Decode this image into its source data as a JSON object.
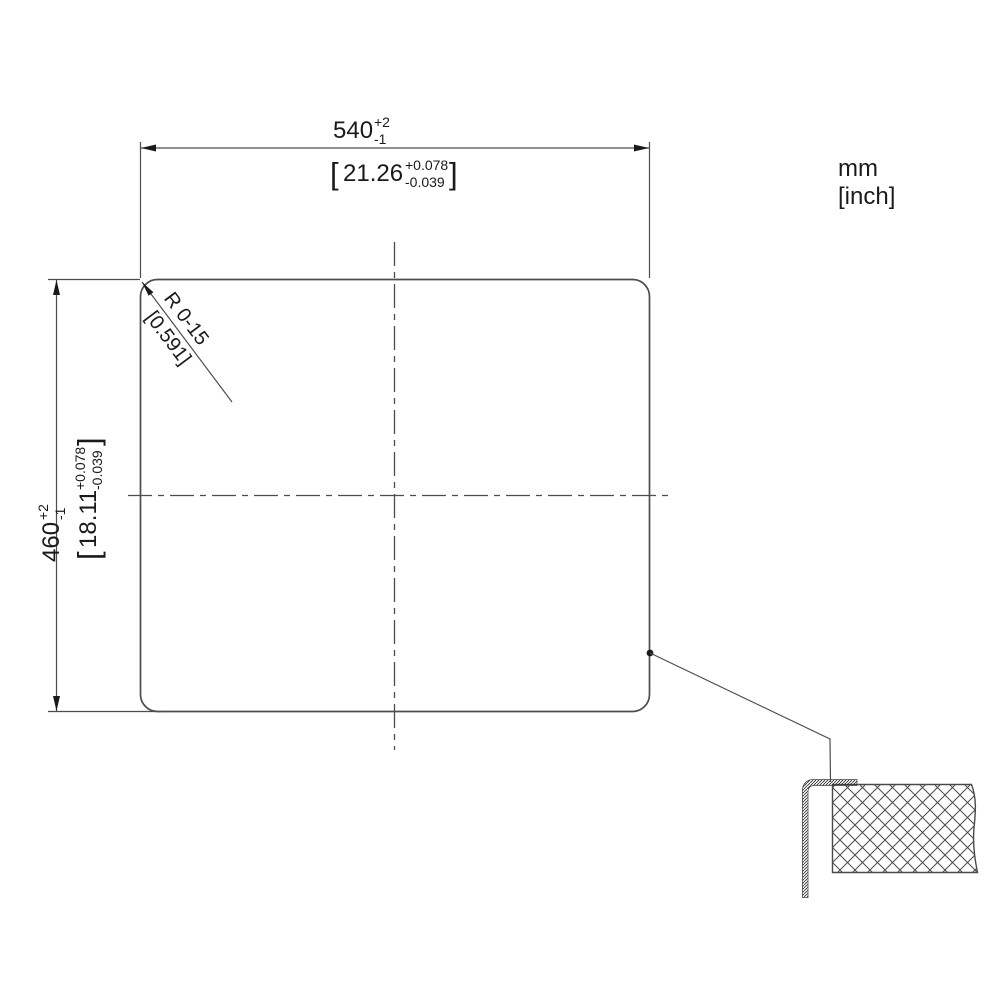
{
  "drawing": {
    "title": "sink-cutout-installation-drawing",
    "units": {
      "primary": "mm",
      "secondary": "[inch]"
    },
    "width_dim": {
      "value": "540",
      "tol_plus": "+2",
      "tol_minus": "-1",
      "bracket_open": "[",
      "inch_value": "21.26",
      "inch_tol_plus": "+0.078",
      "inch_tol_minus": "-0.039",
      "bracket_close": "]"
    },
    "height_dim": {
      "value": "460",
      "tol_plus": "+2",
      "tol_minus": "-1",
      "bracket_open": "[",
      "inch_value": "18.11",
      "inch_tol_plus": "+0.078",
      "inch_tol_minus": "-0.039",
      "bracket_close": "]"
    },
    "radius_dim": {
      "label": "R 0-15",
      "inch_label": "[0.591]"
    },
    "colors": {
      "line": "#4d4d4d",
      "text": "#1a1a1a",
      "background": "#ffffff"
    }
  }
}
